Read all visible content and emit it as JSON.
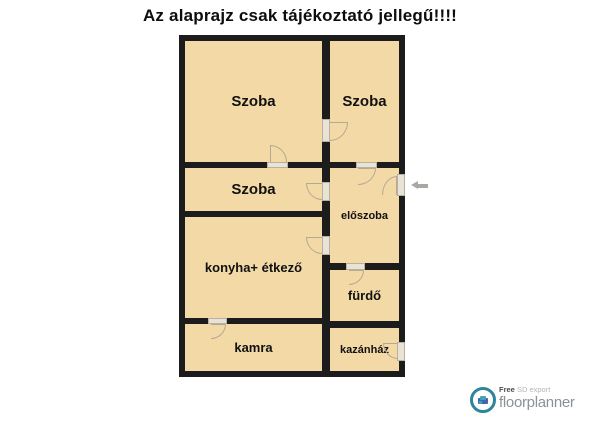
{
  "title": "Az alaprajz csak tájékoztató jellegű!!!!",
  "rooms": [
    {
      "id": "szoba-1",
      "label": "Szoba"
    },
    {
      "id": "szoba-2",
      "label": "Szoba"
    },
    {
      "id": "szoba-3",
      "label": "Szoba"
    },
    {
      "id": "eloszoba",
      "label": "előszoba"
    },
    {
      "id": "konyha-etkezo",
      "label": "konyha+ étkező"
    },
    {
      "id": "furdo",
      "label": "fürdő"
    },
    {
      "id": "kamra",
      "label": "kamra"
    },
    {
      "id": "kazanhaz",
      "label": "kazánház"
    }
  ],
  "watermark": {
    "free_label": "Free",
    "export_label": "SD export",
    "brand": "floorplanner"
  },
  "colors": {
    "room_fill": "#f3d9a6",
    "wall": "#1c1c1c",
    "accent_teal": "#2e8599",
    "brand_gray": "#8a9298"
  }
}
